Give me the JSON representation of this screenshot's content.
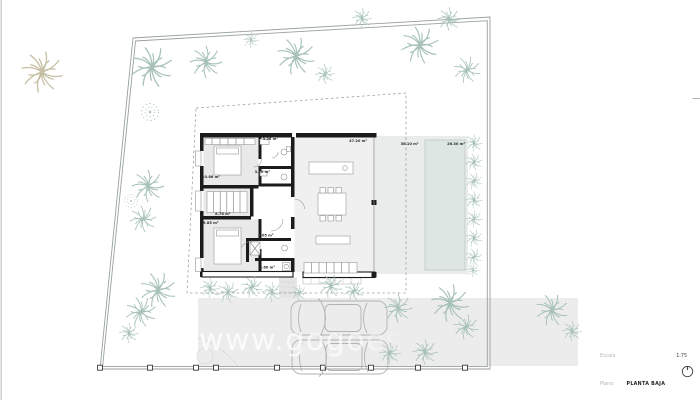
{
  "plan": {
    "watermark": "www.gogoes",
    "rooms": [
      {
        "name": "bathroom-1",
        "area": "3.26 m²"
      },
      {
        "name": "bathroom-2",
        "area": "3.80 m²"
      },
      {
        "name": "bedroom-1",
        "area": "10.86 m²"
      },
      {
        "name": "bedroom-2",
        "area": "8.76 m²"
      },
      {
        "name": "bedroom-3",
        "area": "9.85 m²"
      },
      {
        "name": "bathroom-3",
        "area": "4.05 m²"
      },
      {
        "name": "laundry",
        "area": "3.60 m²"
      },
      {
        "name": "living-dining-kitchen",
        "area": "47.20 m²"
      },
      {
        "name": "terrace",
        "area": "36.10 m²"
      },
      {
        "name": "pool",
        "area": "26.30 m²"
      }
    ]
  },
  "titleblock": {
    "scale_label": "Escala",
    "scale_value": "1:75",
    "plan_label": "Plano",
    "plan_value": "PLANTA BAJA"
  },
  "colors": {
    "wall": "#1b1b1b",
    "room_fill": "#e9e9e9",
    "living_fill": "#f0f0f0",
    "terrace_fill": "#e9ecea",
    "pool_fill": "#dde6e2",
    "driveway_fill": "#ececec",
    "tree_stroke": "#a7c1b9",
    "tree_tan": "#c6bfa3",
    "boundary": "#97a19e",
    "label_text": "#2b2b2b"
  }
}
